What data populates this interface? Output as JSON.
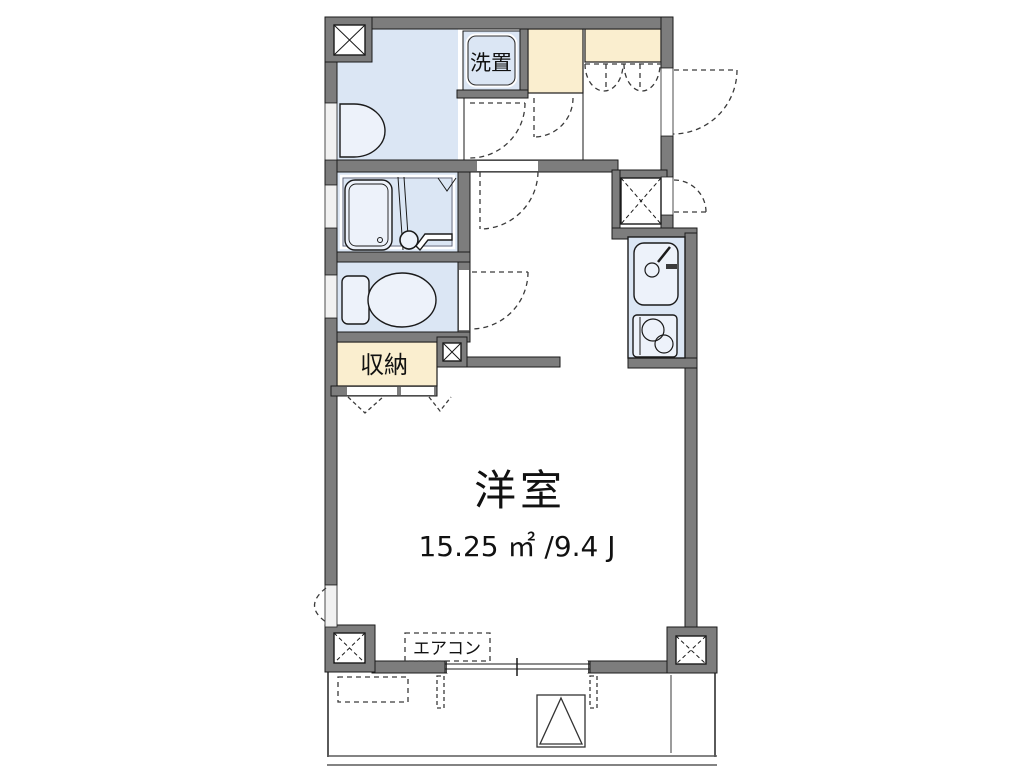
{
  "floorplan": {
    "labels": {
      "washer_space": "洗置",
      "storage": "収納",
      "main_room": "洋室",
      "main_room_area": "15.25 ㎡ /9.4 J",
      "air_conditioner": "エアコン"
    },
    "colors": {
      "wall_gray": "#7d7d7d",
      "room_blue": "#dbe6f4",
      "closet_cream": "#faeecf",
      "outline": "#1a1a1a",
      "background": "#ffffff"
    }
  }
}
